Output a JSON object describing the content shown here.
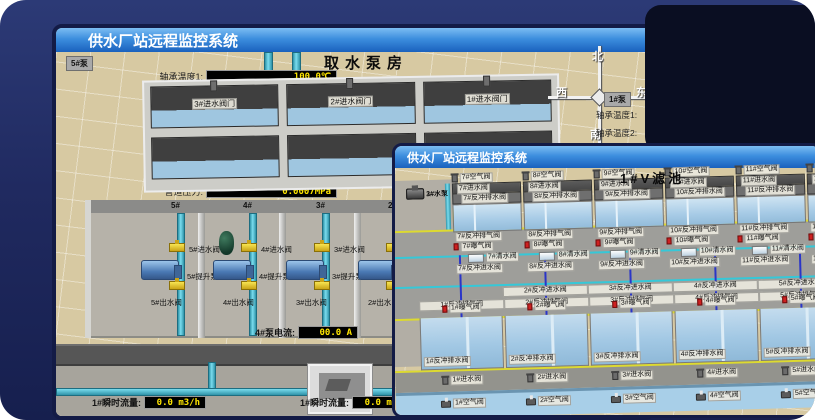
{
  "back_window": {
    "title": "供水厂站远程监控系统",
    "scene_title": "取水泵房",
    "left_panel": {
      "pump_label": "5#泵",
      "fields": [
        {
          "label": "轴承温度1:",
          "value": "100.0℃"
        },
        {
          "label": "轴承温度2:",
          "value": "100.0℃"
        },
        {
          "label": "电机温度1:",
          "value": "18.1℃"
        },
        {
          "label": "电机温度2:",
          "value": "17.9℃"
        },
        {
          "label": "绕组温度1:",
          "value": "18.0℃"
        },
        {
          "label": "绕组温度2:",
          "value": "18.1℃"
        },
        {
          "label": "绕组温度3:",
          "value": "18.1℃"
        },
        {
          "label": "管道压力:",
          "value": "0.0007MPa"
        },
        {
          "label": "多功能阀:",
          "value": "0%"
        }
      ]
    },
    "intake": {
      "valve_labels": [
        "3#进水阀门",
        "2#进水阀门",
        "1#进水阀门"
      ]
    },
    "compass": {
      "north": "北",
      "south": "南",
      "west": "西",
      "east": "东"
    },
    "right_panel": {
      "pump_label": "1#泵",
      "labels": [
        "轴承温度1:",
        "轴承温度2:"
      ]
    },
    "pump_hall": {
      "bays": [
        {
          "bay": "5#",
          "inlet": "5#进水阀",
          "pump": "5#提升泵",
          "outlet": "5#出水阀"
        },
        {
          "bay": "4#",
          "inlet": "4#进水阀",
          "pump": "4#提升泵",
          "outlet": "4#出水阀"
        },
        {
          "bay": "3#",
          "inlet": "3#进水阀",
          "pump": "3#提升泵",
          "outlet": "3#出水阀"
        },
        {
          "bay": "2#",
          "inlet": "2#进水阀",
          "pump": "2#提升泵",
          "outlet": "2#出水阀"
        }
      ]
    },
    "current_row": [
      {
        "label": "4#泵电流:",
        "value": "00.0 A"
      },
      {
        "label": "2#泵电流:",
        "value": ""
      }
    ],
    "flow_row": [
      {
        "label": "1#瞬时流量:",
        "value": "0.0 m3/h"
      },
      {
        "label": "1#瞬时流量:",
        "value": "0.0 m3/h"
      }
    ]
  },
  "front_window": {
    "title": "供水厂站远程监控系统",
    "scene_title": "1#V滤池",
    "equipment": {
      "pumps": [
        "1#水泵",
        "2#水泵",
        "3#水泵"
      ],
      "fans": [
        "1#风机",
        "2#风机",
        "3#风机"
      ]
    },
    "top_cells": [
      {
        "air": "7#空气阀",
        "inlet": "7#进水阀",
        "drain": "7#反冲排水阀",
        "vent": "7#反冲排气阀",
        "aeration": "7#曝气阀",
        "clean": "7#清水阀",
        "backwash": "7#反冲进水阀"
      },
      {
        "air": "8#空气阀",
        "inlet": "8#进水阀",
        "drain": "8#反冲排水阀",
        "vent": "8#反冲排气阀",
        "aeration": "8#曝气阀",
        "clean": "8#清水阀",
        "backwash": "8#反冲进水阀"
      },
      {
        "air": "9#空气阀",
        "inlet": "9#进水阀",
        "drain": "9#反冲排水阀",
        "vent": "9#反冲排气阀",
        "aeration": "9#曝气阀",
        "clean": "9#清水阀",
        "backwash": "9#反冲进水阀"
      },
      {
        "air": "10#空气阀",
        "inlet": "10#进水阀",
        "drain": "10#反冲排水阀",
        "vent": "10#反冲排气阀",
        "aeration": "10#曝气阀",
        "clean": "10#清水阀",
        "backwash": "10#反冲进水阀"
      },
      {
        "air": "11#空气阀",
        "inlet": "11#进水阀",
        "drain": "11#反冲排水阀",
        "vent": "11#反冲排气阀",
        "aeration": "11#曝气阀",
        "clean": "11#清水阀",
        "backwash": "11#反冲进水阀"
      },
      {
        "air": "12#空气阀",
        "inlet": "12#进水阀",
        "drain": "12#反冲排水阀",
        "vent": "12#反冲排气阀",
        "aeration": "12#曝气阀",
        "clean": "12#清水阀",
        "backwash": "12#反冲进水阀"
      }
    ],
    "mid_backwash": [
      "2#反冲进水阀",
      "3#反冲进水阀",
      "4#反冲进水阀",
      "5#反冲进水阀"
    ],
    "bottom_cells": [
      {
        "vent": "1#反冲排气阀",
        "aeration": "1#曝气阀",
        "drain": "1#反冲排水阀",
        "inlet": "1#进水阀",
        "air": "1#空气阀"
      },
      {
        "vent": "2#反冲排气阀",
        "aeration": "2#曝气阀",
        "drain": "2#反冲排水阀",
        "inlet": "2#进水阀",
        "air": "2#空气阀"
      },
      {
        "vent": "3#反冲排气阀",
        "aeration": "3#曝气阀",
        "drain": "3#反冲排水阀",
        "inlet": "3#进水阀",
        "air": "3#空气阀"
      },
      {
        "vent": "4#反冲排气阀",
        "aeration": "4#曝气阀",
        "drain": "4#反冲排水阀",
        "inlet": "4#进水阀",
        "air": "4#空气阀"
      },
      {
        "vent": "5#反冲排气阀",
        "aeration": "5#曝气阀",
        "drain": "5#反冲排水阀",
        "inlet": "5#进水阀",
        "air": "5#空气阀"
      }
    ]
  }
}
